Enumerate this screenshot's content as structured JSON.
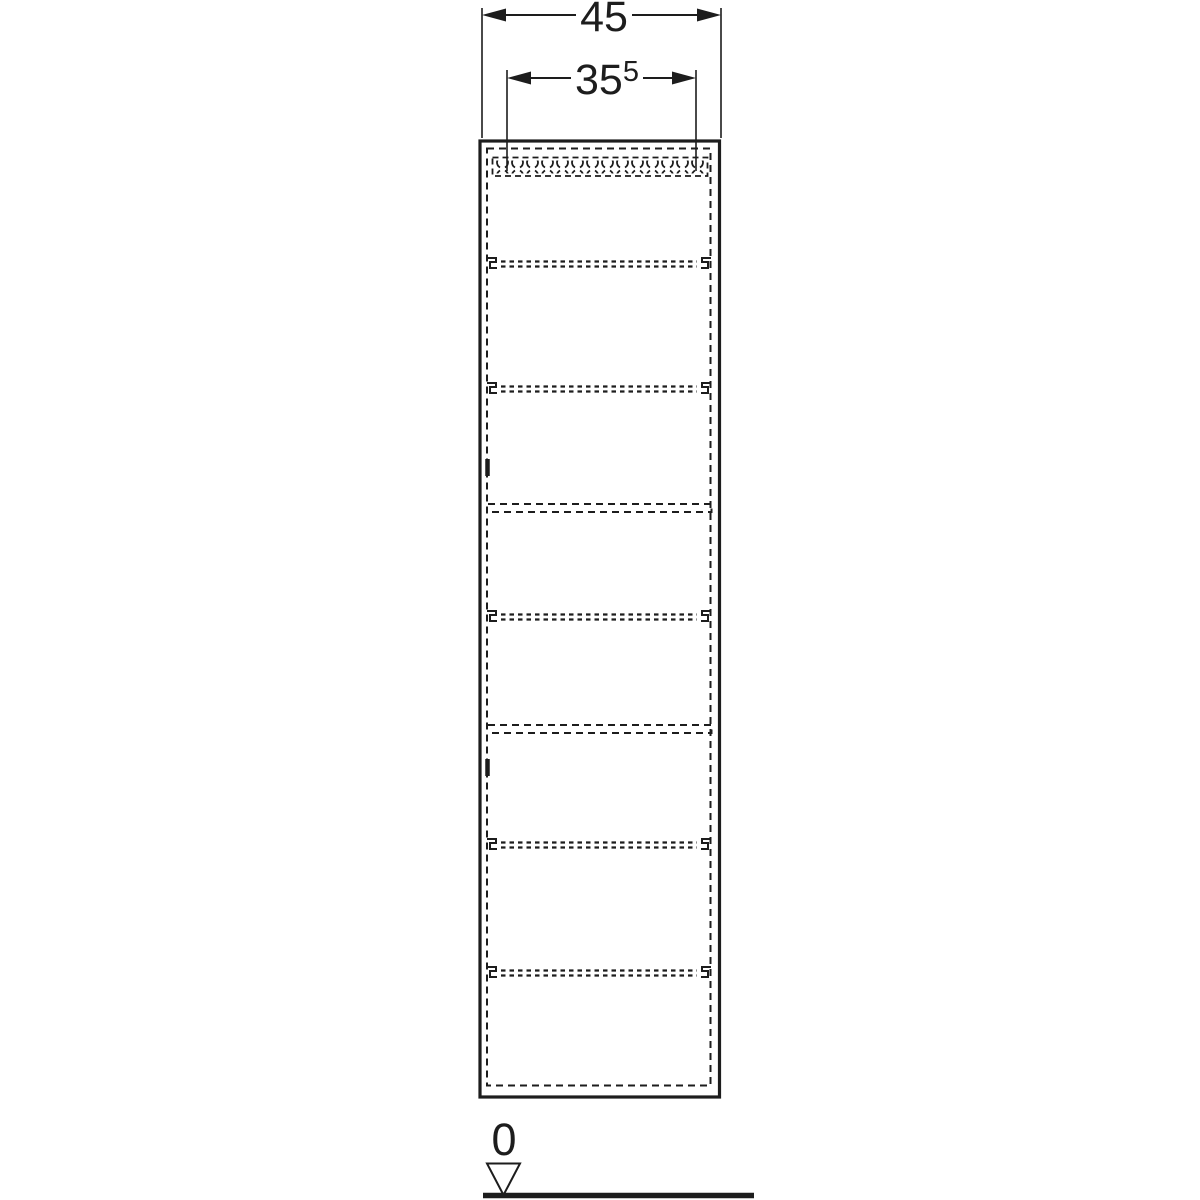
{
  "dimensions": {
    "overall_width": {
      "value": "45"
    },
    "inner_width": {
      "value": "35",
      "sup": "5"
    }
  },
  "datum": {
    "zero_label": "0"
  },
  "colors": {
    "line": "#1d1d1d",
    "background": "#ffffff"
  }
}
